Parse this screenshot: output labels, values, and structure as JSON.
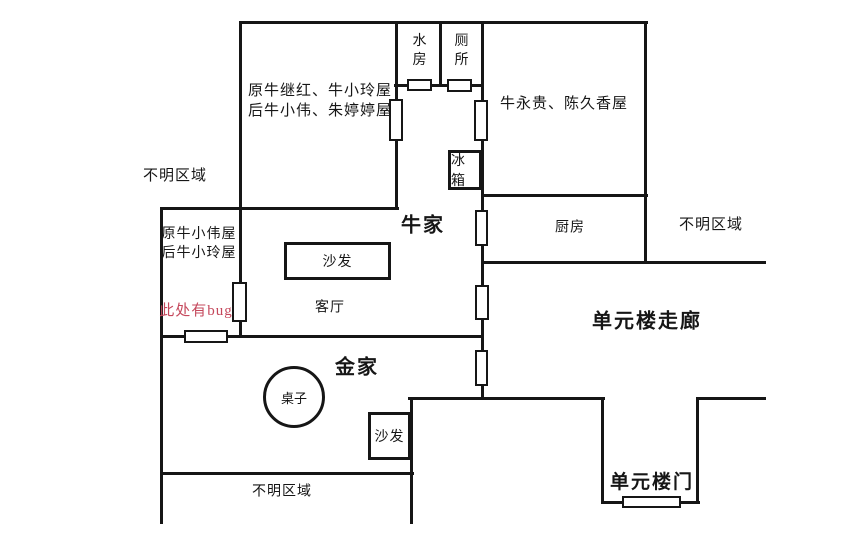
{
  "diagram": {
    "background": "#ffffff",
    "line_color": "#161616",
    "bug_text_color": "#c5485c",
    "wall_thickness": 3,
    "walls": [
      {
        "name": "wall-top",
        "x1": 240,
        "y1": 22,
        "x2": 646,
        "y2": 22
      },
      {
        "name": "wall-waterroom-bottom",
        "x1": 395,
        "y1": 85,
        "x2": 482,
        "y2": 85
      },
      {
        "name": "wall-kitchen-top",
        "x1": 482,
        "y1": 195,
        "x2": 646,
        "y2": 195
      },
      {
        "name": "wall-northroom-bottom",
        "x1": 161,
        "y1": 208,
        "x2": 397,
        "y2": 208
      },
      {
        "name": "wall-corridor-top",
        "x1": 482,
        "y1": 262,
        "x2": 764,
        "y2": 262
      },
      {
        "name": "wall-livingroom-bottom",
        "x1": 161,
        "y1": 336,
        "x2": 482,
        "y2": 336
      },
      {
        "name": "wall-corridor-bottom-left",
        "x1": 409,
        "y1": 398,
        "x2": 603,
        "y2": 398
      },
      {
        "name": "wall-corridor-bottom-right",
        "x1": 697,
        "y1": 398,
        "x2": 764,
        "y2": 398
      },
      {
        "name": "wall-entry-alcove-bottom",
        "x1": 602,
        "y1": 502,
        "x2": 698,
        "y2": 502
      },
      {
        "name": "wall-jin-home-bottom",
        "x1": 161,
        "y1": 473,
        "x2": 412,
        "y2": 473
      },
      {
        "name": "wall-northroom-left",
        "x1": 240,
        "y1": 22,
        "x2": 240,
        "y2": 336
      },
      {
        "name": "wall-northroom-right",
        "x1": 396,
        "y1": 22,
        "x2": 396,
        "y2": 208
      },
      {
        "name": "wall-waterroom-toilet-divider",
        "x1": 440,
        "y1": 22,
        "x2": 440,
        "y2": 85
      },
      {
        "name": "wall-central-vertical",
        "x1": 482,
        "y1": 22,
        "x2": 482,
        "y2": 398
      },
      {
        "name": "wall-east-rooms-right",
        "x1": 645,
        "y1": 22,
        "x2": 645,
        "y2": 262
      },
      {
        "name": "wall-west-outer",
        "x1": 161,
        "y1": 208,
        "x2": 161,
        "y2": 522
      },
      {
        "name": "wall-jin-home-right",
        "x1": 411,
        "y1": 398,
        "x2": 411,
        "y2": 522
      },
      {
        "name": "wall-entry-alcove-left",
        "x1": 602,
        "y1": 398,
        "x2": 602,
        "y2": 502
      },
      {
        "name": "wall-entry-alcove-right",
        "x1": 697,
        "y1": 398,
        "x2": 697,
        "y2": 502
      }
    ],
    "doors": [
      {
        "name": "door-water-room",
        "x": 407,
        "y": 79,
        "w": 25,
        "h": 12
      },
      {
        "name": "door-toilet",
        "x": 447,
        "y": 79,
        "w": 25,
        "h": 13
      },
      {
        "name": "door-north-room",
        "x": 389,
        "y": 99,
        "w": 14,
        "h": 42
      },
      {
        "name": "door-niuyonggui-room",
        "x": 474,
        "y": 100,
        "w": 14,
        "h": 41
      },
      {
        "name": "door-kitchen",
        "x": 475,
        "y": 210,
        "w": 13,
        "h": 36
      },
      {
        "name": "door-corridor-mid",
        "x": 475,
        "y": 285,
        "w": 14,
        "h": 35
      },
      {
        "name": "door-jin-home",
        "x": 475,
        "y": 350,
        "w": 13,
        "h": 36
      },
      {
        "name": "door-xiaowei-room",
        "x": 232,
        "y": 282,
        "w": 15,
        "h": 40
      },
      {
        "name": "door-niu-home",
        "x": 184,
        "y": 330,
        "w": 44,
        "h": 13
      },
      {
        "name": "door-unit-building",
        "x": 622,
        "y": 496,
        "w": 59,
        "h": 12
      }
    ],
    "furniture_boxes": [
      {
        "name": "sofa-niu-livingroom",
        "label": "沙发",
        "x": 284,
        "y": 242,
        "w": 107,
        "h": 38
      },
      {
        "name": "fridge",
        "label": "冰箱",
        "x": 448,
        "y": 150,
        "w": 34,
        "h": 40
      },
      {
        "name": "sofa-jin-home",
        "label": "沙发",
        "x": 368,
        "y": 412,
        "w": 43,
        "h": 48
      }
    ],
    "furniture_circles": [
      {
        "name": "table-jin-home",
        "label": "桌子",
        "cx": 294,
        "cy": 397,
        "r": 31
      }
    ],
    "labels": [
      {
        "name": "label-north-room",
        "text": "原牛继红、牛小玲屋\n后牛小伟、朱婷婷屋",
        "cx": 320,
        "cy": 101,
        "size": 15,
        "bold": false
      },
      {
        "name": "label-niuyonggui-room",
        "text": "牛永贵、陈久香屋",
        "cx": 564,
        "cy": 104,
        "size": 15,
        "bold": false
      },
      {
        "name": "label-water-room",
        "text": "水\n房",
        "cx": 420,
        "cy": 52,
        "size": 14,
        "bold": false
      },
      {
        "name": "label-toilet",
        "text": "厕\n所",
        "cx": 462,
        "cy": 52,
        "size": 14,
        "bold": false
      },
      {
        "name": "label-unknown-top-left",
        "text": "不明区域",
        "cx": 175,
        "cy": 176,
        "size": 15,
        "bold": false
      },
      {
        "name": "label-unknown-right",
        "text": "不明区域",
        "cx": 711,
        "cy": 225,
        "size": 15,
        "bold": false
      },
      {
        "name": "label-kitchen",
        "text": "厨房",
        "cx": 570,
        "cy": 229,
        "size": 14,
        "bold": false
      },
      {
        "name": "label-niu-home",
        "text": "牛家",
        "cx": 423,
        "cy": 226,
        "size": 20,
        "bold": true
      },
      {
        "name": "label-xiaowei-room",
        "text": "原牛小伟屋\n后牛小玲屋",
        "cx": 199,
        "cy": 245,
        "size": 14,
        "bold": false
      },
      {
        "name": "label-bug-note",
        "text": "此处有bug",
        "cx": 196,
        "cy": 311,
        "size": 15,
        "bold": false,
        "color": "#c5485c"
      },
      {
        "name": "label-livingroom",
        "text": "客厅",
        "cx": 330,
        "cy": 309,
        "size": 14,
        "bold": false
      },
      {
        "name": "label-unit-corridor",
        "text": "单元楼走廊",
        "cx": 647,
        "cy": 322,
        "size": 20,
        "bold": true
      },
      {
        "name": "label-jin-home",
        "text": "金家",
        "cx": 357,
        "cy": 368,
        "size": 20,
        "bold": true
      },
      {
        "name": "label-unknown-bottom",
        "text": "不明区域",
        "cx": 282,
        "cy": 493,
        "size": 14,
        "bold": false
      },
      {
        "name": "label-unit-door",
        "text": "单元楼门",
        "cx": 652,
        "cy": 483,
        "size": 19,
        "bold": true
      }
    ]
  }
}
